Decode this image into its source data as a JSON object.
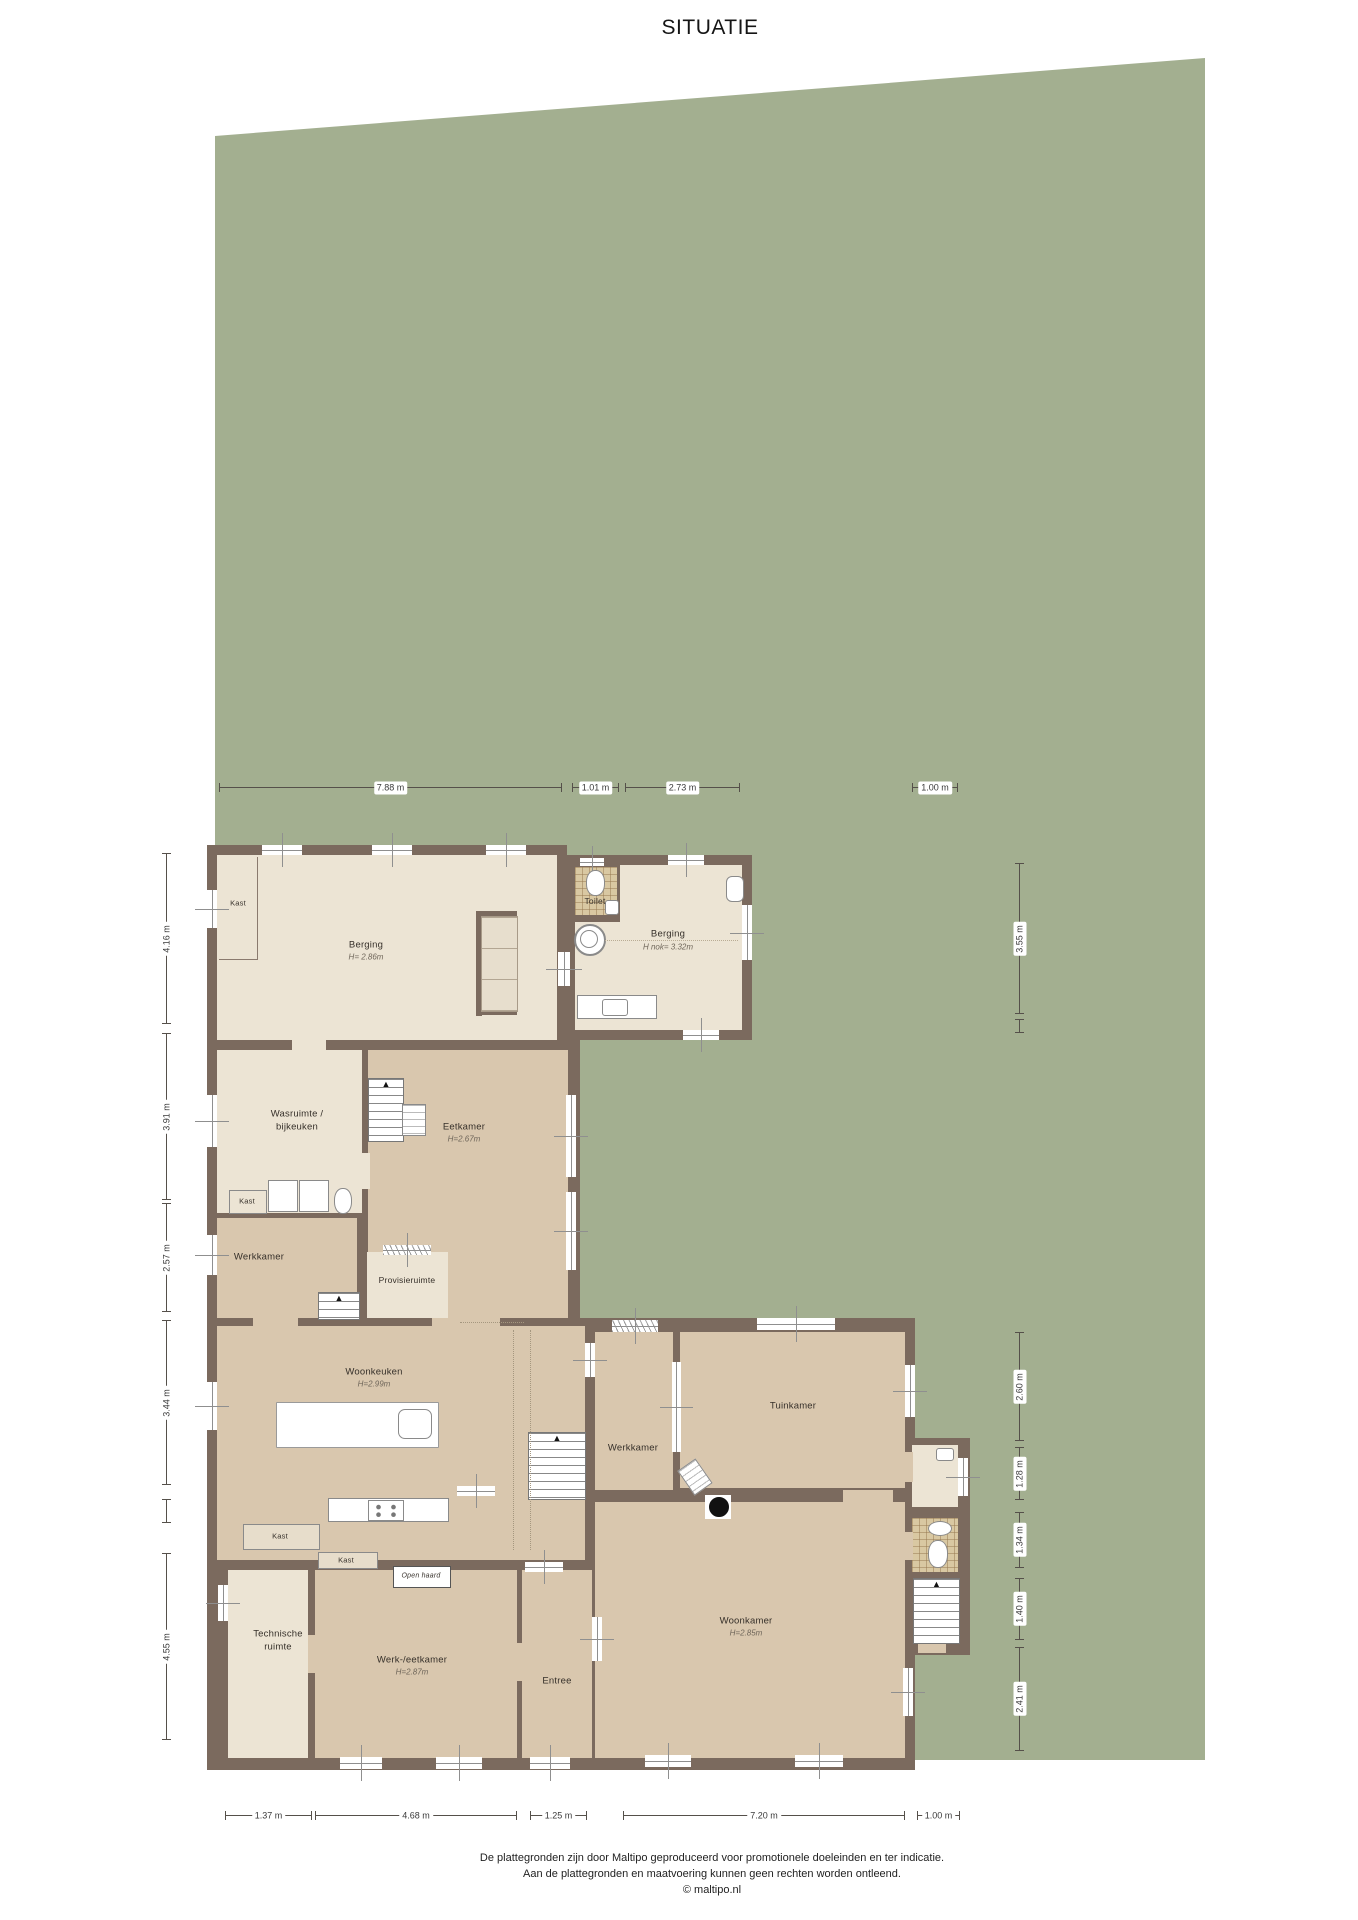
{
  "title": "SITUATIE",
  "colors": {
    "plot_green": "#a3af90",
    "wall_brown": "#7b6a5e",
    "room_light": "#ece4d4",
    "room_tan": "#d9c7ae",
    "tile": "#d9c8a2"
  },
  "rooms": {
    "berging_left": {
      "name": "Berging",
      "height": "H= 2.86m"
    },
    "toilet": {
      "name": "Toilet"
    },
    "berging_right": {
      "name": "Berging",
      "height": "H nok= 3.32m"
    },
    "wasruimte": {
      "name": "Wasruimte /",
      "name2": "bijkeuken"
    },
    "eetkamer": {
      "name": "Eetkamer",
      "height": "H=2.67m"
    },
    "werkkamer_left": {
      "name": "Werkkamer"
    },
    "provisieruimte": {
      "name": "Provisieruimte"
    },
    "woonkeuken": {
      "name": "Woonkeuken",
      "height": "H=2.99m"
    },
    "werkkamer_center": {
      "name": "Werkkamer"
    },
    "tuinkamer": {
      "name": "Tuinkamer"
    },
    "woonkamer": {
      "name": "Woonkamer",
      "height": "H=2.85m"
    },
    "entree": {
      "name": "Entree"
    },
    "werk_eetkamer": {
      "name": "Werk-/eetkamer",
      "height": "H=2.87m"
    },
    "technische_ruimte": {
      "name": "Technische",
      "name2": "ruimte"
    }
  },
  "labels": {
    "kast": "Kast",
    "open_haard": "Open haard"
  },
  "dimensions": {
    "top": [
      {
        "label": "7.88 m",
        "from": 219,
        "to": 562
      },
      {
        "label": "1.01 m",
        "from": 572,
        "to": 619
      },
      {
        "label": "2.73 m",
        "from": 625,
        "to": 740
      },
      {
        "label": "1.00 m",
        "from": 912,
        "to": 958
      }
    ],
    "left": [
      {
        "label": "4.16 m",
        "from": 853,
        "to": 1024
      },
      {
        "label": "3.91 m",
        "from": 1033,
        "to": 1200
      },
      {
        "label": "2.57 m",
        "from": 1203,
        "to": 1312
      },
      {
        "label": "3.44 m",
        "from": 1320,
        "to": 1485
      },
      {
        "label": "",
        "from": 1499,
        "to": 1523
      },
      {
        "label": "4.55 m",
        "from": 1553,
        "to": 1740
      }
    ],
    "right": [
      {
        "label": "3.55 m",
        "from": 863,
        "to": 1014
      },
      {
        "label": "",
        "from": 1019,
        "to": 1033
      },
      {
        "label": "2.60 m",
        "from": 1332,
        "to": 1441
      },
      {
        "label": "1.28 m",
        "from": 1447,
        "to": 1500
      },
      {
        "label": "1.34 m",
        "from": 1512,
        "to": 1568
      },
      {
        "label": "1.40 m",
        "from": 1578,
        "to": 1640
      },
      {
        "label": "2.41 m",
        "from": 1647,
        "to": 1751
      }
    ],
    "bottom": [
      {
        "label": "1.37 m",
        "from": 225,
        "to": 312
      },
      {
        "label": "4.68 m",
        "from": 315,
        "to": 517
      },
      {
        "label": "1.25 m",
        "from": 530,
        "to": 587
      },
      {
        "label": "7.20 m",
        "from": 623,
        "to": 905
      },
      {
        "label": "1.00 m",
        "from": 917,
        "to": 960
      }
    ]
  },
  "footer": {
    "line1": "De plattegronden zijn door Maltipo geproduceerd voor promotionele doeleinden en ter indicatie.",
    "line2": "Aan de plattegronden en maatvoering kunnen geen rechten worden ontleend.",
    "line3": "© maltipo.nl"
  }
}
